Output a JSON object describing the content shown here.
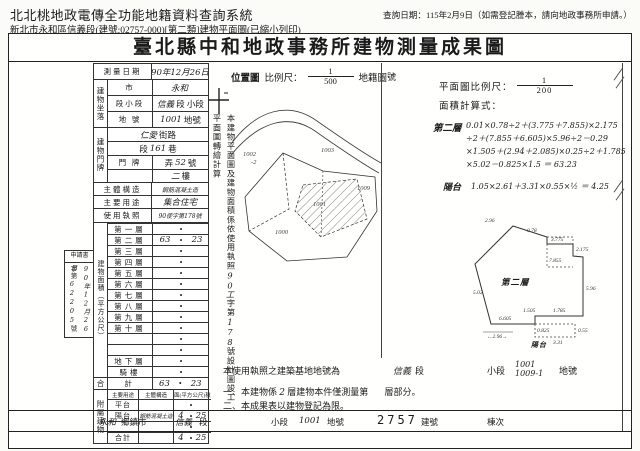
{
  "header": {
    "app_title": "北北桃地政電傳全功能地籍資料查詢系統",
    "query_date": "查詢日期：115年2月9日（如需登記謄本，請向地政事務所申請。）",
    "sub_line": "新北市永和區信義段(建號:02757-000)[第二類]建物平面圖(已縮小列印)"
  },
  "doc": {
    "title": "臺北縣中和地政事務所建物測量成果圖",
    "receipt": {
      "label": "申請書",
      "no_prefix": "字第",
      "no_value": "62205",
      "no_suffix": "號",
      "date": "90年12月26日"
    },
    "table": {
      "dot": "•",
      "survey_label": "測量日期",
      "survey_value": "90年12月26日",
      "site_label": "建物坐落",
      "site_rows": [
        {
          "label": "市",
          "pre": "",
          "hw": "永和",
          "post": ""
        },
        {
          "label": "段小段",
          "pre": "",
          "hw": "信義",
          "post": "段 小段"
        },
        {
          "label": "地 號",
          "pre": "",
          "hw": "1001",
          "post": "地號"
        }
      ],
      "door_label": "建物門牌",
      "door_rows": [
        {
          "label": "街 路",
          "pre": "",
          "hw": "仁愛",
          "post": "街路"
        },
        {
          "label": "段 巷",
          "pre": "段",
          "hw": "161",
          "post": "巷"
        },
        {
          "label": "門 牌",
          "pre": "弄",
          "hw": "52",
          "post": "號"
        },
        {
          "label": "",
          "pre": "",
          "hw": "二",
          "post": "樓"
        }
      ],
      "simple_rows": [
        {
          "label": "主體構造",
          "hw": "鋼筋混凝土造"
        },
        {
          "label": "主要用途",
          "hw": "集合住宅"
        },
        {
          "label": "使用執照",
          "hw": "90使字第178號"
        }
      ],
      "area_label": "建物面積（平方公尺）",
      "floors": [
        {
          "label": "第一層",
          "l": "",
          "r": ""
        },
        {
          "label": "第二層",
          "l": "63",
          "r": "23"
        },
        {
          "label": "第三層",
          "l": "",
          "r": ""
        },
        {
          "label": "第四層",
          "l": "",
          "r": ""
        },
        {
          "label": "第五層",
          "l": "",
          "r": ""
        },
        {
          "label": "第六層",
          "l": "",
          "r": ""
        },
        {
          "label": "第七層",
          "l": "",
          "r": ""
        },
        {
          "label": "第八層",
          "l": "",
          "r": ""
        },
        {
          "label": "第九層",
          "l": "",
          "r": ""
        },
        {
          "label": "第十層",
          "l": "",
          "r": ""
        },
        {
          "label": "",
          "l": "",
          "r": ""
        },
        {
          "label": "",
          "l": "",
          "r": ""
        },
        {
          "label": "地下層",
          "l": "",
          "r": ""
        },
        {
          "label": "騎樓",
          "l": "",
          "r": ""
        }
      ],
      "total_outer": "合",
      "total_label": "計",
      "total_l": "63",
      "total_r": "23",
      "annex_label": "附屬建物",
      "annex_header": {
        "use": "主要用途",
        "struct": "主體構造",
        "area": "面(平方公尺)積"
      },
      "annex_rows": [
        {
          "u": "平台",
          "s": "",
          "l": "",
          "r": ""
        },
        {
          "u": "陽台",
          "s": "鋼筋混凝土造",
          "l": "4",
          "r": "25"
        },
        {
          "u": "",
          "s": "",
          "l": "",
          "r": ""
        },
        {
          "u": "合計",
          "s": "",
          "l": "4",
          "r": "25"
        }
      ]
    },
    "strip": {
      "p1": "本建物平面圖及建物面積係依使用執照",
      "hw1": "90工",
      "p2": "字第",
      "hw2": "178",
      "p3": "號設計圖竣工平面圖轉繪計算"
    },
    "locmap": {
      "title": "位置圖",
      "scale_label": "比例尺：",
      "frac_num": "1",
      "frac_den": "500",
      "map_label": "地籍圖",
      "labels": [
        {
          "t": "1002"
        },
        {
          "t": "-2"
        },
        {
          "t": "1003"
        },
        {
          "t": "1009"
        },
        {
          "t": "1000"
        },
        {
          "t": "1001"
        }
      ]
    },
    "right": {
      "no_label": "號",
      "scale_label": "平面圖比例尺：",
      "frac_num": "1",
      "frac_den": "200",
      "calc_label": "面積計算式：",
      "f2_label": "第二層",
      "f2_lines": [
        "0.01×0.78÷2＋(3.775＋7.855)×2.175",
        "÷2＋(7.855＋6.605)×5.96÷2－0.29",
        "×1.505＋(2.94＋2.085)×0.25÷2＋1.785",
        "×5.02－0.825×1.5 ＝ 63.23"
      ],
      "balc_label": "陽台",
      "balc_line": "1.05×2.61＋3.31×0.55×½ ＝ 4.25",
      "plan_label": "第二層",
      "plan_balc": "陽台",
      "dims": [
        {
          "t": "2.96"
        },
        {
          "t": "0.78"
        },
        {
          "t": "3.775"
        },
        {
          "t": "2.175"
        },
        {
          "t": "7.855"
        },
        {
          "t": "5.96"
        },
        {
          "t": "6.605"
        },
        {
          "t": "1.505"
        },
        {
          "t": "1.785"
        },
        {
          "t": "5.02"
        },
        {
          "t": "0.825"
        },
        {
          "t": "←2.96→"
        },
        {
          "t": "3.31"
        },
        {
          "t": "0.55"
        }
      ],
      "base": {
        "lead": "本使用執照之建築基地地號為",
        "hw1": "信義",
        "seg": "段",
        "xiao": "小段",
        "hw2": "1001",
        "hw3": "1009-1",
        "tail": "地號"
      },
      "note1": {
        "pre": "一、本建物係",
        "hw": "2",
        "mid": "層建物本件僅測量第",
        "tail": "層部分。"
      },
      "note2": "二、本成果表以建物登記為限。"
    },
    "bottom": {
      "v1": "永和",
      "l1": "鄉鎮市",
      "v2": "信義",
      "l2": "段",
      "l3": "小段",
      "v3": "1001",
      "l4": "地號",
      "v4": "2757",
      "l5": "建號",
      "l6": "棟次"
    }
  }
}
